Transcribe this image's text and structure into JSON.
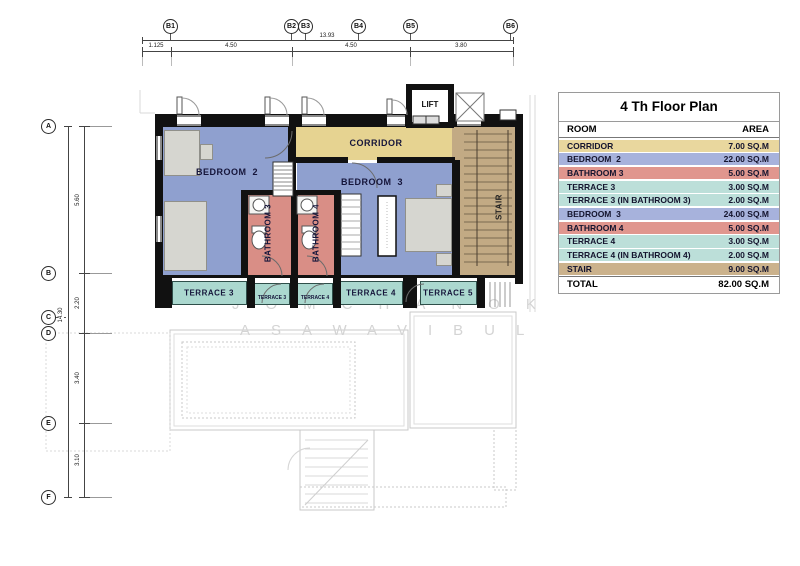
{
  "sheet": {
    "watermark_line1": "JOMCHANOK",
    "watermark_line2": "ASAWAVIBUL"
  },
  "grid_top": {
    "labels": [
      "B1",
      "B2",
      "B3",
      "B4",
      "B5",
      "B6"
    ],
    "total_dim": "13.93",
    "segment_dims": [
      "1.125",
      "4.50",
      "4.50",
      "3.80"
    ]
  },
  "grid_left": {
    "labels": [
      "A",
      "B",
      "C",
      "D",
      "E",
      "F"
    ],
    "total_dim": "14.30",
    "segment_dims": [
      "5.60",
      "2.20",
      "3.40",
      "3.10"
    ]
  },
  "plan": {
    "labels": {
      "lift": "LIFT",
      "corridor": "CORRIDOR",
      "bedroom2": "BEDROOM  2",
      "bedroom3": "BEDROOM  3",
      "bathroom3": "BATHROOM 3",
      "bathroom4": "BATHROOM 4",
      "stair": "STAIR",
      "terrace3": "TERRACE 3",
      "terrace3_small": "TERRACE 3",
      "terrace4_small": "TERRACE 4",
      "terrace4": "TERRACE 4",
      "terrace5": "TERRACE 5"
    },
    "colors": {
      "bedroom": "#8fa0cf",
      "bathroom": "#d98e86",
      "corridor": "#e6d391",
      "stair": "#c2aa84",
      "terrace": "#abd8cf",
      "wall": "#111111"
    }
  },
  "table": {
    "title": "4 Th Floor Plan",
    "columns": [
      "ROOM",
      "AREA"
    ],
    "rows": [
      {
        "room": "CORRIDOR",
        "area": "7.00 SQ.M",
        "color": "#e9d79e"
      },
      {
        "room": "BEDROOM  2",
        "area": "22.00 SQ.M",
        "color": "#a7b2dc"
      },
      {
        "room": "BATHROOM 3",
        "area": "5.00 SQ.M",
        "color": "#e0968e"
      },
      {
        "room": "TERRACE 3",
        "area": "3.00 SQ.M",
        "color": "#bcdfd9"
      },
      {
        "room": "TERRACE 3 (IN BATHROOM 3)",
        "area": "2.00 SQ.M",
        "color": "#bcdfd9"
      },
      {
        "room": "BEDROOM  3",
        "area": "24.00 SQ.M",
        "color": "#a7b2dc"
      },
      {
        "room": "BATHROOM 4",
        "area": "5.00 SQ.M",
        "color": "#e0968e"
      },
      {
        "room": "TERRACE 4",
        "area": "3.00 SQ.M",
        "color": "#bcdfd9"
      },
      {
        "room": "TERRACE 4 (IN BATHROOM 4)",
        "area": "2.00 SQ.M",
        "color": "#bcdfd9"
      },
      {
        "room": "STAIR",
        "area": "9.00 SQ.M",
        "color": "#cbb28c"
      }
    ],
    "total": {
      "room": "TOTAL",
      "area": "82.00 SQ.M"
    }
  }
}
